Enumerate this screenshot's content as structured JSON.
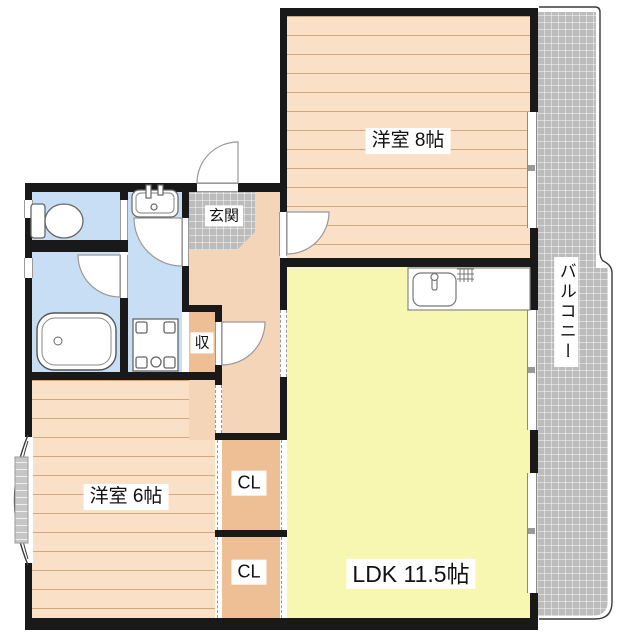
{
  "floorplan": {
    "rooms": {
      "western8": {
        "label": "洋室 8帖"
      },
      "ldk": {
        "label": "LDK 11.5帖"
      },
      "western6": {
        "label": "洋室 6帖"
      },
      "balcony": {
        "label": "バルコニー"
      },
      "genkan": {
        "label": "玄関"
      },
      "storage": {
        "label": "収"
      },
      "closet1": {
        "label": "CL"
      },
      "closet2": {
        "label": "CL"
      }
    },
    "fixtures": [
      "toilet-icon",
      "washbasin-icon",
      "bathtub-icon",
      "washer-pan-icon",
      "kitchen-sink-icon",
      "bay-window-icon",
      "door-swing-icon"
    ],
    "colors": {
      "wall": "#191919",
      "tatami_room_fill": "#f9e0c6",
      "tatami_room_stripe": "#d2a87f",
      "ldk_fill": "#f7f7b2",
      "hallway_fill": "#f4d5b8",
      "closet_fill": "#eebf94",
      "wet_area_fill": "#c8def5",
      "tile_and_balcony_gray": "#bcbcbc",
      "label_bg": "#ffffff",
      "label_text": "#111111"
    }
  }
}
